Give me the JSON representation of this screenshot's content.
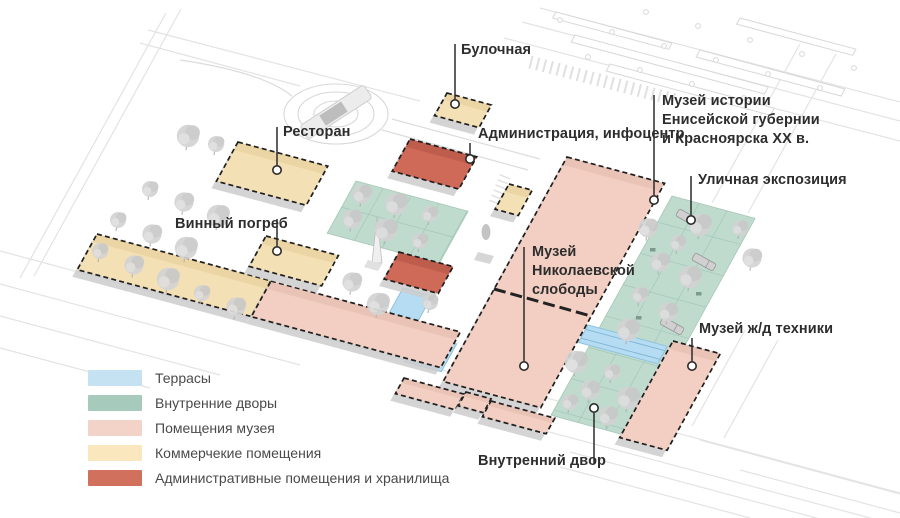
{
  "colors": {
    "background": "#ffffff",
    "ground_line": "#e3e3e3",
    "platform_line": "#d8d8d8",
    "leader": "#2b2b2b",
    "tree": "#d3d3d3",
    "map_fills": {
      "terrace": "#b5dcf2",
      "courtyard": "#bedbce",
      "museum": "#f2cfc2",
      "commercial": "#f4e0b5",
      "admin": "#d06a58"
    },
    "map_bands": {
      "terrace": "#9ecde9",
      "courtyard": "#aecfc0",
      "museum": "#e6bfb1",
      "commercial": "#e8d2a0",
      "admin": "#b95a48"
    },
    "legend_swatches": {
      "terrace": "#c5e2f2",
      "courtyard": "#a6cbbd",
      "museum": "#f3d2c8",
      "commercial": "#fbe7bd",
      "admin": "#d2705e"
    }
  },
  "legend": {
    "items": [
      {
        "key": "terrace",
        "label": "Террасы"
      },
      {
        "key": "courtyard",
        "label": "Внутренние дворы"
      },
      {
        "key": "museum",
        "label": "Помещения музея"
      },
      {
        "key": "commercial",
        "label": "Коммерчекие помещения"
      },
      {
        "key": "admin",
        "label": "Административные помещения и хранилища"
      }
    ]
  },
  "annotations": [
    {
      "id": "bakery",
      "text": "Булочная",
      "tx": 461,
      "ty": 41,
      "line": [
        455,
        44,
        455,
        99
      ],
      "marker": [
        455,
        104
      ]
    },
    {
      "id": "restaurant",
      "text": "Ресторан",
      "tx": 283,
      "ty": 123,
      "line": [
        277,
        127,
        277,
        165
      ],
      "marker": [
        277,
        170
      ]
    },
    {
      "id": "wine-cellar",
      "text": "Винный погреб",
      "tx": 175,
      "ty": 215,
      "line": [
        277,
        219,
        277,
        246
      ],
      "marker": [
        277,
        251
      ]
    },
    {
      "id": "administration",
      "text": "Администрация, инфоцентр",
      "tx": 478,
      "ty": 125,
      "line": [
        470,
        143,
        470,
        154
      ],
      "marker": [
        470,
        159
      ]
    },
    {
      "id": "history-museum",
      "text": "Музей истории\nЕнисейской губернии\nи Красноярска XX в.",
      "tx": 662,
      "ty": 92,
      "line": [
        654,
        95,
        654,
        195
      ],
      "marker": [
        654,
        200
      ]
    },
    {
      "id": "street-expo",
      "text": "Уличная экспозиция",
      "tx": 698,
      "ty": 171,
      "line": [
        691,
        176,
        691,
        215
      ],
      "marker": [
        691,
        220
      ]
    },
    {
      "id": "nikolaev-museum",
      "text": "Музей\nНиколаевской\nслободы",
      "tx": 532,
      "ty": 243,
      "line": [
        524,
        247,
        524,
        361
      ],
      "marker": [
        524,
        366
      ]
    },
    {
      "id": "railway-museum",
      "text": "Музей ж/д техники",
      "tx": 699,
      "ty": 320,
      "line": [
        692,
        338,
        692,
        361
      ],
      "marker": [
        692,
        366
      ]
    },
    {
      "id": "inner-courtyard",
      "text": "Внутренний двор",
      "tx": 478,
      "ty": 452,
      "line": [
        594,
        413,
        594,
        464
      ],
      "marker": [
        594,
        408
      ]
    }
  ],
  "map": {
    "areas": [
      {
        "id": "central-courtyard",
        "category": "courtyard",
        "a": [
          356,
          181
        ],
        "w": 116,
        "h": 60
      },
      {
        "id": "expo-strip",
        "category": "courtyard",
        "a": [
          672,
          196
        ],
        "w": 86,
        "h": 252
      }
    ],
    "terraces": [
      {
        "id": "terrace-strip",
        "a": [
          403,
          288
        ],
        "w": 30,
        "h": 36
      },
      {
        "id": "terrace-square",
        "a": [
          420,
          334
        ],
        "w": 38,
        "h": 32
      },
      {
        "id": "terrace-bridge",
        "a": [
          588,
          325
        ],
        "w": 82,
        "h": 20
      }
    ],
    "buildings": [
      {
        "id": "long-yellow",
        "category": "commercial",
        "a": [
          97,
          234
        ],
        "w": 180,
        "h": 41
      },
      {
        "id": "long-pink",
        "category": "museum",
        "a": [
          271,
          281
        ],
        "w": 196,
        "h": 41
      },
      {
        "id": "restaurant",
        "category": "commercial",
        "a": [
          238,
          142
        ],
        "w": 93,
        "h": 45
      },
      {
        "id": "bakery",
        "category": "commercial",
        "a": [
          447,
          93
        ],
        "w": 46,
        "h": 26
      },
      {
        "id": "wine-cellar",
        "category": "commercial",
        "a": [
          266,
          236
        ],
        "w": 75,
        "h": 35
      },
      {
        "id": "small-yellow",
        "category": "commercial",
        "a": [
          509,
          184
        ],
        "w": 24,
        "h": 29
      },
      {
        "id": "admin-infocenter",
        "category": "admin",
        "a": [
          410,
          139
        ],
        "w": 69,
        "h": 37
      },
      {
        "id": "center-storage",
        "category": "admin",
        "a": [
          399,
          252
        ],
        "w": 56,
        "h": 31
      },
      {
        "id": "main-museum",
        "category": "museum",
        "a": [
          567,
          157
        ],
        "w": 101,
        "h": 258
      },
      {
        "id": "row-a",
        "category": "museum",
        "a": [
          404,
          378
        ],
        "w": 62,
        "h": 18
      },
      {
        "id": "row-jog",
        "category": "museum",
        "a": [
          466,
          392
        ],
        "w": 26,
        "h": 16
      },
      {
        "id": "row-b",
        "category": "museum",
        "a": [
          491,
          401
        ],
        "w": 66,
        "h": 18
      },
      {
        "id": "railway-museum",
        "category": "museum",
        "a": [
          673,
          341
        ],
        "w": 49,
        "h": 111
      }
    ],
    "trees": [
      [
        150,
        189
      ],
      [
        184,
        202
      ],
      [
        218,
        216
      ],
      [
        118,
        220
      ],
      [
        152,
        234
      ],
      [
        186,
        248
      ],
      [
        100,
        251
      ],
      [
        134,
        265
      ],
      [
        168,
        279
      ],
      [
        202,
        293
      ],
      [
        236,
        307
      ],
      [
        188,
        136
      ],
      [
        216,
        144
      ],
      [
        362,
        194
      ],
      [
        396,
        204
      ],
      [
        430,
        214
      ],
      [
        352,
        219
      ],
      [
        386,
        230
      ],
      [
        420,
        241
      ],
      [
        352,
        282
      ],
      [
        378,
        304
      ],
      [
        430,
        302
      ],
      [
        648,
        228
      ],
      [
        700,
        225
      ],
      [
        678,
        243
      ],
      [
        660,
        262
      ],
      [
        690,
        277
      ],
      [
        640,
        295
      ],
      [
        668,
        312
      ],
      [
        628,
        330
      ],
      [
        740,
        228
      ],
      [
        752,
        258
      ],
      [
        576,
        362
      ],
      [
        612,
        372
      ],
      [
        590,
        390
      ],
      [
        628,
        398
      ],
      [
        570,
        402
      ],
      [
        608,
        416
      ]
    ],
    "trains": [
      [
        688,
        218
      ],
      [
        704,
        262
      ],
      [
        672,
        326
      ]
    ],
    "benches": [
      [
        650,
        248
      ],
      [
        696,
        292
      ],
      [
        636,
        316
      ]
    ]
  }
}
